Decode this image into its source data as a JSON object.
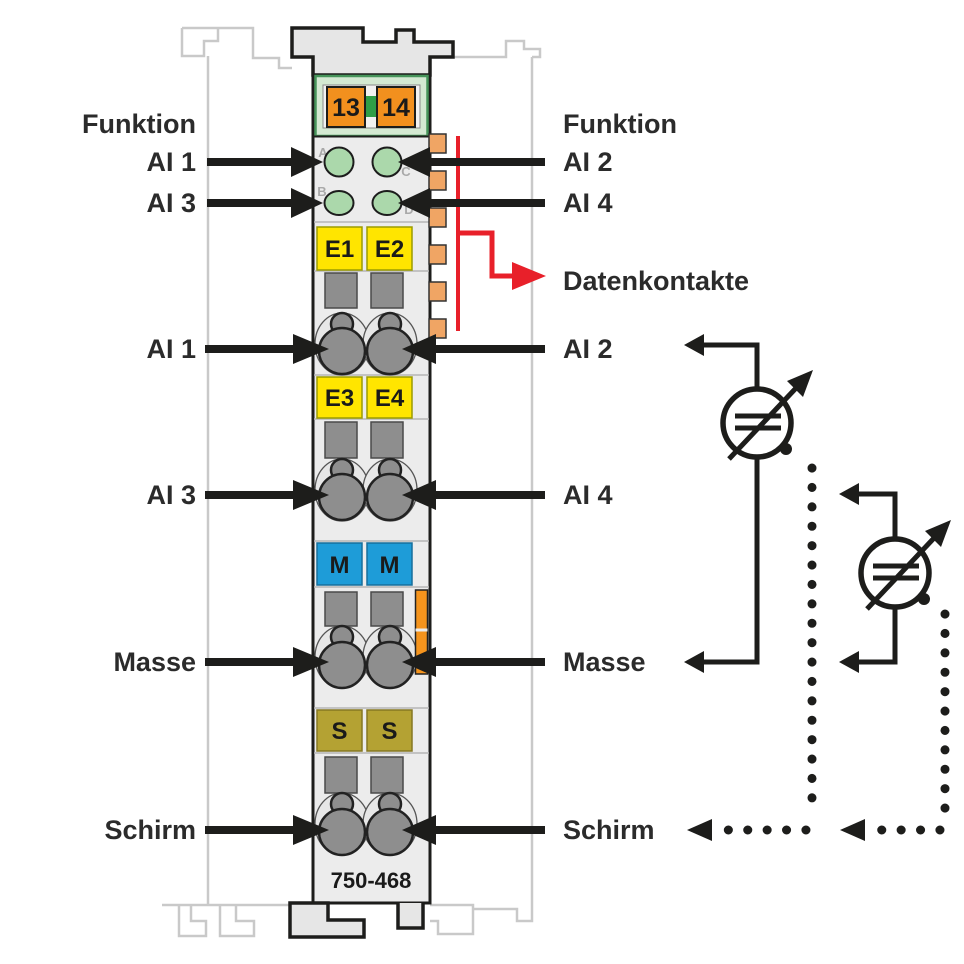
{
  "diagram": {
    "part_number": "750-468",
    "power_jumper_contacts": [
      "13",
      "14"
    ],
    "led_channels": [
      "A",
      "B",
      "C",
      "D"
    ],
    "terminal_markers": {
      "inputs": [
        "E1",
        "E2",
        "E3",
        "E4"
      ],
      "ground": [
        "M",
        "M"
      ],
      "shield": [
        "S",
        "S"
      ]
    }
  },
  "annotations": {
    "left": [
      {
        "label": "Funktion"
      },
      {
        "label": "AI 1"
      },
      {
        "label": "AI 3"
      },
      {
        "label": "AI 1"
      },
      {
        "label": "AI 3"
      },
      {
        "label": "Masse"
      },
      {
        "label": "Schirm"
      }
    ],
    "right": [
      {
        "label": "Funktion"
      },
      {
        "label": "AI 2"
      },
      {
        "label": "AI 4"
      },
      {
        "label": "Datenkontakte"
      },
      {
        "label": "AI 2"
      },
      {
        "label": "AI 4"
      },
      {
        "label": "Masse"
      },
      {
        "label": "Schirm"
      }
    ]
  },
  "colors": {
    "arrow_black": "#1d1d1b",
    "data_contact_red": "#e8202a",
    "power_contact_orange": "#f2901e",
    "data_tab_orange": "#f0a564",
    "input_yellow": "#ffe500",
    "ground_blue": "#1e9cd8",
    "shield_olive": "#b4a233",
    "led_green": "#abd8ab",
    "panel_green": "#d4e9d2",
    "rail_gray": "#c9c9c9"
  }
}
